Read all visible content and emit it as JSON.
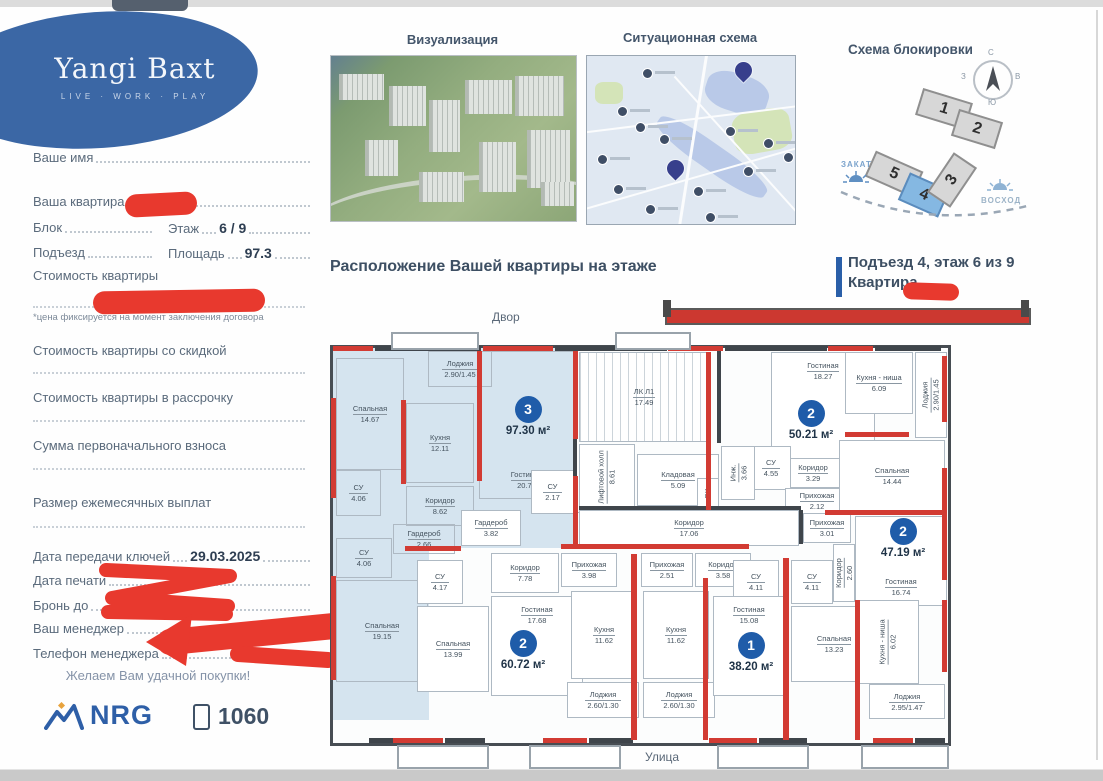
{
  "brand": {
    "name": "Yangi Baxt",
    "tagline": "LIVE · WORK · PLAY"
  },
  "sidebar": {
    "name_label": "Ваше имя",
    "apartment_label": "Ваша квартира",
    "block_label": "Блок",
    "floor_label": "Этаж",
    "floor_value": "6 / 9",
    "entrance_label": "Подъезд",
    "area_label": "Площадь",
    "area_value": "97.3",
    "price_label": "Стоимость квартиры",
    "price_note": "*цена фиксируется на момент заключения договора",
    "price_discount_label": "Стоимость квартиры со скидкой",
    "price_installment_label": "Стоимость квартиры в рассрочку",
    "down_payment_label": "Сумма первоначального взноса",
    "monthly_payment_label": "Размер ежемесячных выплат",
    "keys_date_label": "Дата передачи ключей",
    "keys_date_value": "29.03.2025",
    "print_date_label": "Дата печати",
    "reserve_label": "Бронь до",
    "reserve_note": "не фиксируется",
    "manager_label": "Ваш менеджер",
    "manager_phone_label": "Телефон менеджера",
    "wish": "Желаем Вам удачной покупки!",
    "nrg": "NRG",
    "phone_number": "1060"
  },
  "sections": {
    "visualization": "Визуализация",
    "situational": "Ситуационная схема",
    "blocking": "Схема блокировки"
  },
  "blocking": {
    "compass": {
      "north": "С",
      "south": "Ю",
      "west": "З",
      "east": "В"
    },
    "sunset": "ЗАКАТ",
    "sunrise": "ВОСХОД",
    "highlight_color": "#85b8e2",
    "blocks": [
      {
        "label": "1",
        "x": 83,
        "y": 65,
        "w": 48,
        "h": 24,
        "rot": 17,
        "hl": false
      },
      {
        "label": "2",
        "x": 119,
        "y": 85,
        "w": 42,
        "h": 24,
        "rot": 17,
        "hl": false
      },
      {
        "label": "5",
        "x": 33,
        "y": 130,
        "w": 48,
        "h": 24,
        "rot": 24,
        "hl": false
      },
      {
        "label": "4",
        "x": 67,
        "y": 150,
        "w": 40,
        "h": 26,
        "rot": 24,
        "hl": true
      },
      {
        "label": "3",
        "x": 93,
        "y": 136,
        "w": 44,
        "h": 24,
        "rot": -56,
        "hl": false
      }
    ]
  },
  "location": {
    "heading": "Расположение Вашей квартиры на этаже",
    "entrance_line": "Подъезд 4, этаж 6 из 9",
    "apartment_line": "Квартира",
    "yard": "Двор",
    "street": "Улица"
  },
  "viz": {
    "buildings": [
      [
        8,
        18,
        42,
        26
      ],
      [
        58,
        30,
        34,
        40
      ],
      [
        98,
        44,
        28,
        52
      ],
      [
        134,
        24,
        44,
        34
      ],
      [
        184,
        20,
        46,
        40
      ],
      [
        196,
        74,
        40,
        58
      ],
      [
        148,
        86,
        34,
        50
      ],
      [
        88,
        116,
        42,
        30
      ],
      [
        34,
        84,
        30,
        36
      ],
      [
        210,
        126,
        30,
        24
      ]
    ]
  },
  "map": {
    "markers": [
      {
        "x": 55,
        "y": 12
      },
      {
        "x": 30,
        "y": 50
      },
      {
        "x": 48,
        "y": 66
      },
      {
        "x": 72,
        "y": 78
      },
      {
        "x": 10,
        "y": 98
      },
      {
        "x": 26,
        "y": 128
      },
      {
        "x": 58,
        "y": 148
      },
      {
        "x": 138,
        "y": 70
      },
      {
        "x": 176,
        "y": 82
      },
      {
        "x": 196,
        "y": 96
      },
      {
        "x": 156,
        "y": 110
      },
      {
        "x": 118,
        "y": 156
      },
      {
        "x": 106,
        "y": 130
      }
    ],
    "pins": [
      {
        "x": 148,
        "y": 6
      },
      {
        "x": 80,
        "y": 104
      }
    ]
  },
  "floor_plan": {
    "highlight_fill": "#d5e4ef",
    "wall_red": "#d23b33",
    "apartments": [
      {
        "number": "3",
        "area": "97.30 м²"
      },
      {
        "number": "2",
        "area": "50.21 м²"
      },
      {
        "number": "2",
        "area": "47.19 м²"
      },
      {
        "number": "2",
        "area": "60.72 м²"
      },
      {
        "number": "1",
        "area": "38.20 м²"
      }
    ],
    "badges": [
      {
        "n": "3",
        "area": "97.30 м²",
        "x": 163,
        "y": 48
      },
      {
        "n": "2",
        "area": "50.21 м²",
        "x": 446,
        "y": 52
      },
      {
        "n": "2",
        "area": "47.19 м²",
        "x": 538,
        "y": 170
      },
      {
        "n": "2",
        "area": "60.72 м²",
        "x": 158,
        "y": 282
      },
      {
        "n": "1",
        "area": "38.20 м²",
        "x": 386,
        "y": 284
      }
    ],
    "blue_zones": [
      {
        "x": 0,
        "y": 0,
        "w": 241,
        "h": 200
      },
      {
        "x": 0,
        "y": 180,
        "w": 96,
        "h": 192
      }
    ],
    "rooms": [
      {
        "name": "Лоджия",
        "area": "2.90/1.45",
        "x": 95,
        "y": 3,
        "w": 62,
        "h": 34,
        "cls": ""
      },
      {
        "name": "Спальная",
        "area": "14.67",
        "x": 3,
        "y": 10,
        "w": 66,
        "h": 110,
        "cls": ""
      },
      {
        "name": "Кухня",
        "area": "12.11",
        "x": 73,
        "y": 55,
        "w": 66,
        "h": 78,
        "cls": ""
      },
      {
        "name": "Гостиная",
        "area": "20.78",
        "x": 146,
        "y": 3,
        "w": 93,
        "h": 138,
        "cls": "lb"
      },
      {
        "name": "СУ",
        "area": "4.06",
        "x": 3,
        "y": 122,
        "w": 43,
        "h": 44,
        "cls": ""
      },
      {
        "name": "Коридор",
        "area": "8.62",
        "x": 73,
        "y": 138,
        "w": 66,
        "h": 38,
        "cls": ""
      },
      {
        "name": "СУ",
        "area": "2.17",
        "x": 198,
        "y": 122,
        "w": 41,
        "h": 42,
        "cls": "w"
      },
      {
        "name": "Гардероб",
        "area": "3.82",
        "x": 128,
        "y": 162,
        "w": 58,
        "h": 34,
        "cls": "w"
      },
      {
        "name": "Гардероб",
        "area": "2.66",
        "x": 60,
        "y": 176,
        "w": 60,
        "h": 28,
        "cls": ""
      },
      {
        "name": "Прихожая",
        "area": "3.75",
        "x": 240,
        "y": 164,
        "w": 50,
        "h": 34,
        "cls": "w"
      },
      {
        "name": "СУ",
        "area": "4.06",
        "x": 3,
        "y": 190,
        "w": 54,
        "h": 38,
        "cls": ""
      },
      {
        "name": "Спальная",
        "area": "19.15",
        "x": 3,
        "y": 232,
        "w": 90,
        "h": 100,
        "cls": ""
      },
      {
        "name": "СУ",
        "area": "4.17",
        "x": 84,
        "y": 212,
        "w": 44,
        "h": 42,
        "cls": "w"
      },
      {
        "name": "Спальная",
        "area": "13.99",
        "x": 84,
        "y": 258,
        "w": 70,
        "h": 84,
        "cls": "w"
      },
      {
        "name": "Коридор",
        "area": "7.78",
        "x": 158,
        "y": 205,
        "w": 66,
        "h": 38,
        "cls": "w"
      },
      {
        "name": "Гостиная",
        "area": "17.68",
        "x": 158,
        "y": 248,
        "w": 90,
        "h": 90,
        "cls": "w lt"
      },
      {
        "name": "Прихожая",
        "area": "3.98",
        "x": 228,
        "y": 205,
        "w": 54,
        "h": 32,
        "cls": "w"
      },
      {
        "name": "Кухня",
        "area": "11.62",
        "x": 238,
        "y": 243,
        "w": 64,
        "h": 86,
        "cls": "w"
      },
      {
        "name": "Лоджия",
        "area": "2.60/1.30",
        "x": 234,
        "y": 334,
        "w": 70,
        "h": 34,
        "cls": "w"
      },
      {
        "name": "Прихожая",
        "area": "2.51",
        "x": 308,
        "y": 205,
        "w": 50,
        "h": 32,
        "cls": "w"
      },
      {
        "name": "Кухня",
        "area": "11.62",
        "x": 310,
        "y": 243,
        "w": 64,
        "h": 86,
        "cls": "w"
      },
      {
        "name": "Лоджия",
        "area": "2.60/1.30",
        "x": 310,
        "y": 334,
        "w": 70,
        "h": 34,
        "cls": "w"
      },
      {
        "name": "Коридор",
        "area": "3.58",
        "x": 362,
        "y": 205,
        "w": 54,
        "h": 32,
        "cls": "w"
      },
      {
        "name": "СУ",
        "area": "4.11",
        "x": 400,
        "y": 212,
        "w": 44,
        "h": 42,
        "cls": "w"
      },
      {
        "name": "Гостиная",
        "area": "15.08",
        "x": 380,
        "y": 248,
        "w": 70,
        "h": 90,
        "cls": "w lt"
      },
      {
        "name": "СУ",
        "area": "4.11",
        "x": 458,
        "y": 212,
        "w": 40,
        "h": 42,
        "cls": "w"
      },
      {
        "name": "Коридор",
        "area": "2.60",
        "x": 500,
        "y": 196,
        "w": 20,
        "h": 56,
        "cls": "w v"
      },
      {
        "name": "Спальная",
        "area": "13.23",
        "x": 458,
        "y": 258,
        "w": 84,
        "h": 74,
        "cls": "w"
      },
      {
        "name": "Гостиная",
        "area": "16.74",
        "x": 522,
        "y": 168,
        "w": 90,
        "h": 80,
        "cls": "w lb"
      },
      {
        "name": "Кухня - ниша",
        "area": "6.02",
        "x": 524,
        "y": 252,
        "w": 60,
        "h": 82,
        "cls": "w v"
      },
      {
        "name": "Лоджия",
        "area": "2.95/1.47",
        "x": 536,
        "y": 336,
        "w": 74,
        "h": 33,
        "cls": "w"
      },
      {
        "name": "Прихожая",
        "area": "3.01",
        "x": 470,
        "y": 165,
        "w": 46,
        "h": 28,
        "cls": "w"
      },
      {
        "name": "Гостиная",
        "area": "18.27",
        "x": 438,
        "y": 4,
        "w": 102,
        "h": 104,
        "cls": "w lt"
      },
      {
        "name": "Коридор",
        "area": "3.29",
        "x": 444,
        "y": 110,
        "w": 70,
        "h": 28,
        "cls": "w"
      },
      {
        "name": "СУ",
        "area": "4.55",
        "x": 418,
        "y": 98,
        "w": 38,
        "h": 42,
        "cls": "w"
      },
      {
        "name": "Прихожая",
        "area": "2.12",
        "x": 452,
        "y": 140,
        "w": 62,
        "h": 24,
        "cls": "w"
      },
      {
        "name": "Кухня - ниша",
        "area": "6.09",
        "x": 512,
        "y": 4,
        "w": 66,
        "h": 60,
        "cls": "w"
      },
      {
        "name": "Лоджия",
        "area": "2.90/1.45",
        "x": 582,
        "y": 4,
        "w": 30,
        "h": 84,
        "cls": "w v"
      },
      {
        "name": "Спальная",
        "area": "14.44",
        "x": 506,
        "y": 92,
        "w": 104,
        "h": 70,
        "cls": "w"
      },
      {
        "name": "ЛК Л1",
        "area": "17.49",
        "x": 246,
        "y": 4,
        "w": 128,
        "h": 88,
        "cls": "w stairs"
      },
      {
        "name": "Лифтовой холл",
        "area": "8.61",
        "x": 246,
        "y": 96,
        "w": 54,
        "h": 64,
        "cls": "w v"
      },
      {
        "name": "Кладовая",
        "area": "5.09",
        "x": 304,
        "y": 106,
        "w": 80,
        "h": 50,
        "cls": "w"
      },
      {
        "name": "Инж.",
        "area": "3.66",
        "x": 388,
        "y": 98,
        "w": 32,
        "h": 52,
        "cls": "w v"
      },
      {
        "name": "ВК",
        "area": "",
        "x": 364,
        "y": 130,
        "w": 20,
        "h": 28,
        "cls": "w v"
      },
      {
        "name": "Коридор",
        "area": "17.06",
        "x": 246,
        "y": 162,
        "w": 218,
        "h": 34,
        "cls": "w"
      }
    ],
    "red_walls": [
      {
        "x": 0,
        "y": -2,
        "w": 40,
        "h": 5
      },
      {
        "x": 150,
        "y": -2,
        "w": 70,
        "h": 5
      },
      {
        "x": 335,
        "y": -2,
        "w": 55,
        "h": 5
      },
      {
        "x": 495,
        "y": -2,
        "w": 45,
        "h": 5
      },
      {
        "x": -2,
        "y": 50,
        "w": 5,
        "h": 100
      },
      {
        "x": -2,
        "y": 228,
        "w": 5,
        "h": 104
      },
      {
        "x": 609,
        "y": 8,
        "w": 5,
        "h": 66
      },
      {
        "x": 609,
        "y": 120,
        "w": 5,
        "h": 112
      },
      {
        "x": 609,
        "y": 252,
        "w": 5,
        "h": 72
      },
      {
        "x": 60,
        "y": 390,
        "w": 50,
        "h": 5
      },
      {
        "x": 210,
        "y": 390,
        "w": 44,
        "h": 5
      },
      {
        "x": 376,
        "y": 390,
        "w": 48,
        "h": 5
      },
      {
        "x": 540,
        "y": 390,
        "w": 40,
        "h": 5
      },
      {
        "x": 144,
        "y": 3,
        "w": 5,
        "h": 130
      },
      {
        "x": 68,
        "y": 52,
        "w": 5,
        "h": 84
      },
      {
        "x": 240,
        "y": 3,
        "w": 5,
        "h": 88
      },
      {
        "x": 240,
        "y": 128,
        "w": 5,
        "h": 70
      },
      {
        "x": 72,
        "y": 198,
        "w": 56,
        "h": 5
      },
      {
        "x": 228,
        "y": 196,
        "w": 188,
        "h": 5
      },
      {
        "x": 298,
        "y": 206,
        "w": 6,
        "h": 186
      },
      {
        "x": 450,
        "y": 210,
        "w": 6,
        "h": 182
      },
      {
        "x": 370,
        "y": 230,
        "w": 5,
        "h": 162
      },
      {
        "x": 522,
        "y": 252,
        "w": 5,
        "h": 140
      },
      {
        "x": 492,
        "y": 162,
        "w": 120,
        "h": 5
      },
      {
        "x": 373,
        "y": 4,
        "w": 5,
        "h": 158
      },
      {
        "x": 512,
        "y": 84,
        "w": 64,
        "h": 5
      }
    ],
    "dark_walls": [
      {
        "x": 240,
        "y": 91,
        "w": 4,
        "h": 40
      },
      {
        "x": 384,
        "y": 3,
        "w": 4,
        "h": 92
      },
      {
        "x": 246,
        "y": 158,
        "w": 222,
        "h": 4
      },
      {
        "x": 466,
        "y": 162,
        "w": 4,
        "h": 34
      },
      {
        "x": 36,
        "y": 390,
        "w": 26,
        "h": 5
      },
      {
        "x": 112,
        "y": 390,
        "w": 40,
        "h": 5
      },
      {
        "x": 256,
        "y": 390,
        "w": 44,
        "h": 5
      },
      {
        "x": 426,
        "y": 390,
        "w": 48,
        "h": 5
      },
      {
        "x": 582,
        "y": 390,
        "w": 30,
        "h": 5
      },
      {
        "x": 42,
        "y": -2,
        "w": 106,
        "h": 5
      },
      {
        "x": 222,
        "y": -2,
        "w": 112,
        "h": 5
      },
      {
        "x": 392,
        "y": -2,
        "w": 102,
        "h": 5
      },
      {
        "x": 542,
        "y": -2,
        "w": 66,
        "h": 5
      }
    ],
    "out_boxes": [
      {
        "x": 58,
        "y": -16,
        "w": 84,
        "h": 14
      },
      {
        "x": 282,
        "y": -16,
        "w": 72,
        "h": 14
      },
      {
        "x": 64,
        "y": 397,
        "w": 88,
        "h": 20
      },
      {
        "x": 196,
        "y": 397,
        "w": 88,
        "h": 20
      },
      {
        "x": 384,
        "y": 397,
        "w": 88,
        "h": 20
      },
      {
        "x": 528,
        "y": 397,
        "w": 84,
        "h": 20
      }
    ]
  }
}
